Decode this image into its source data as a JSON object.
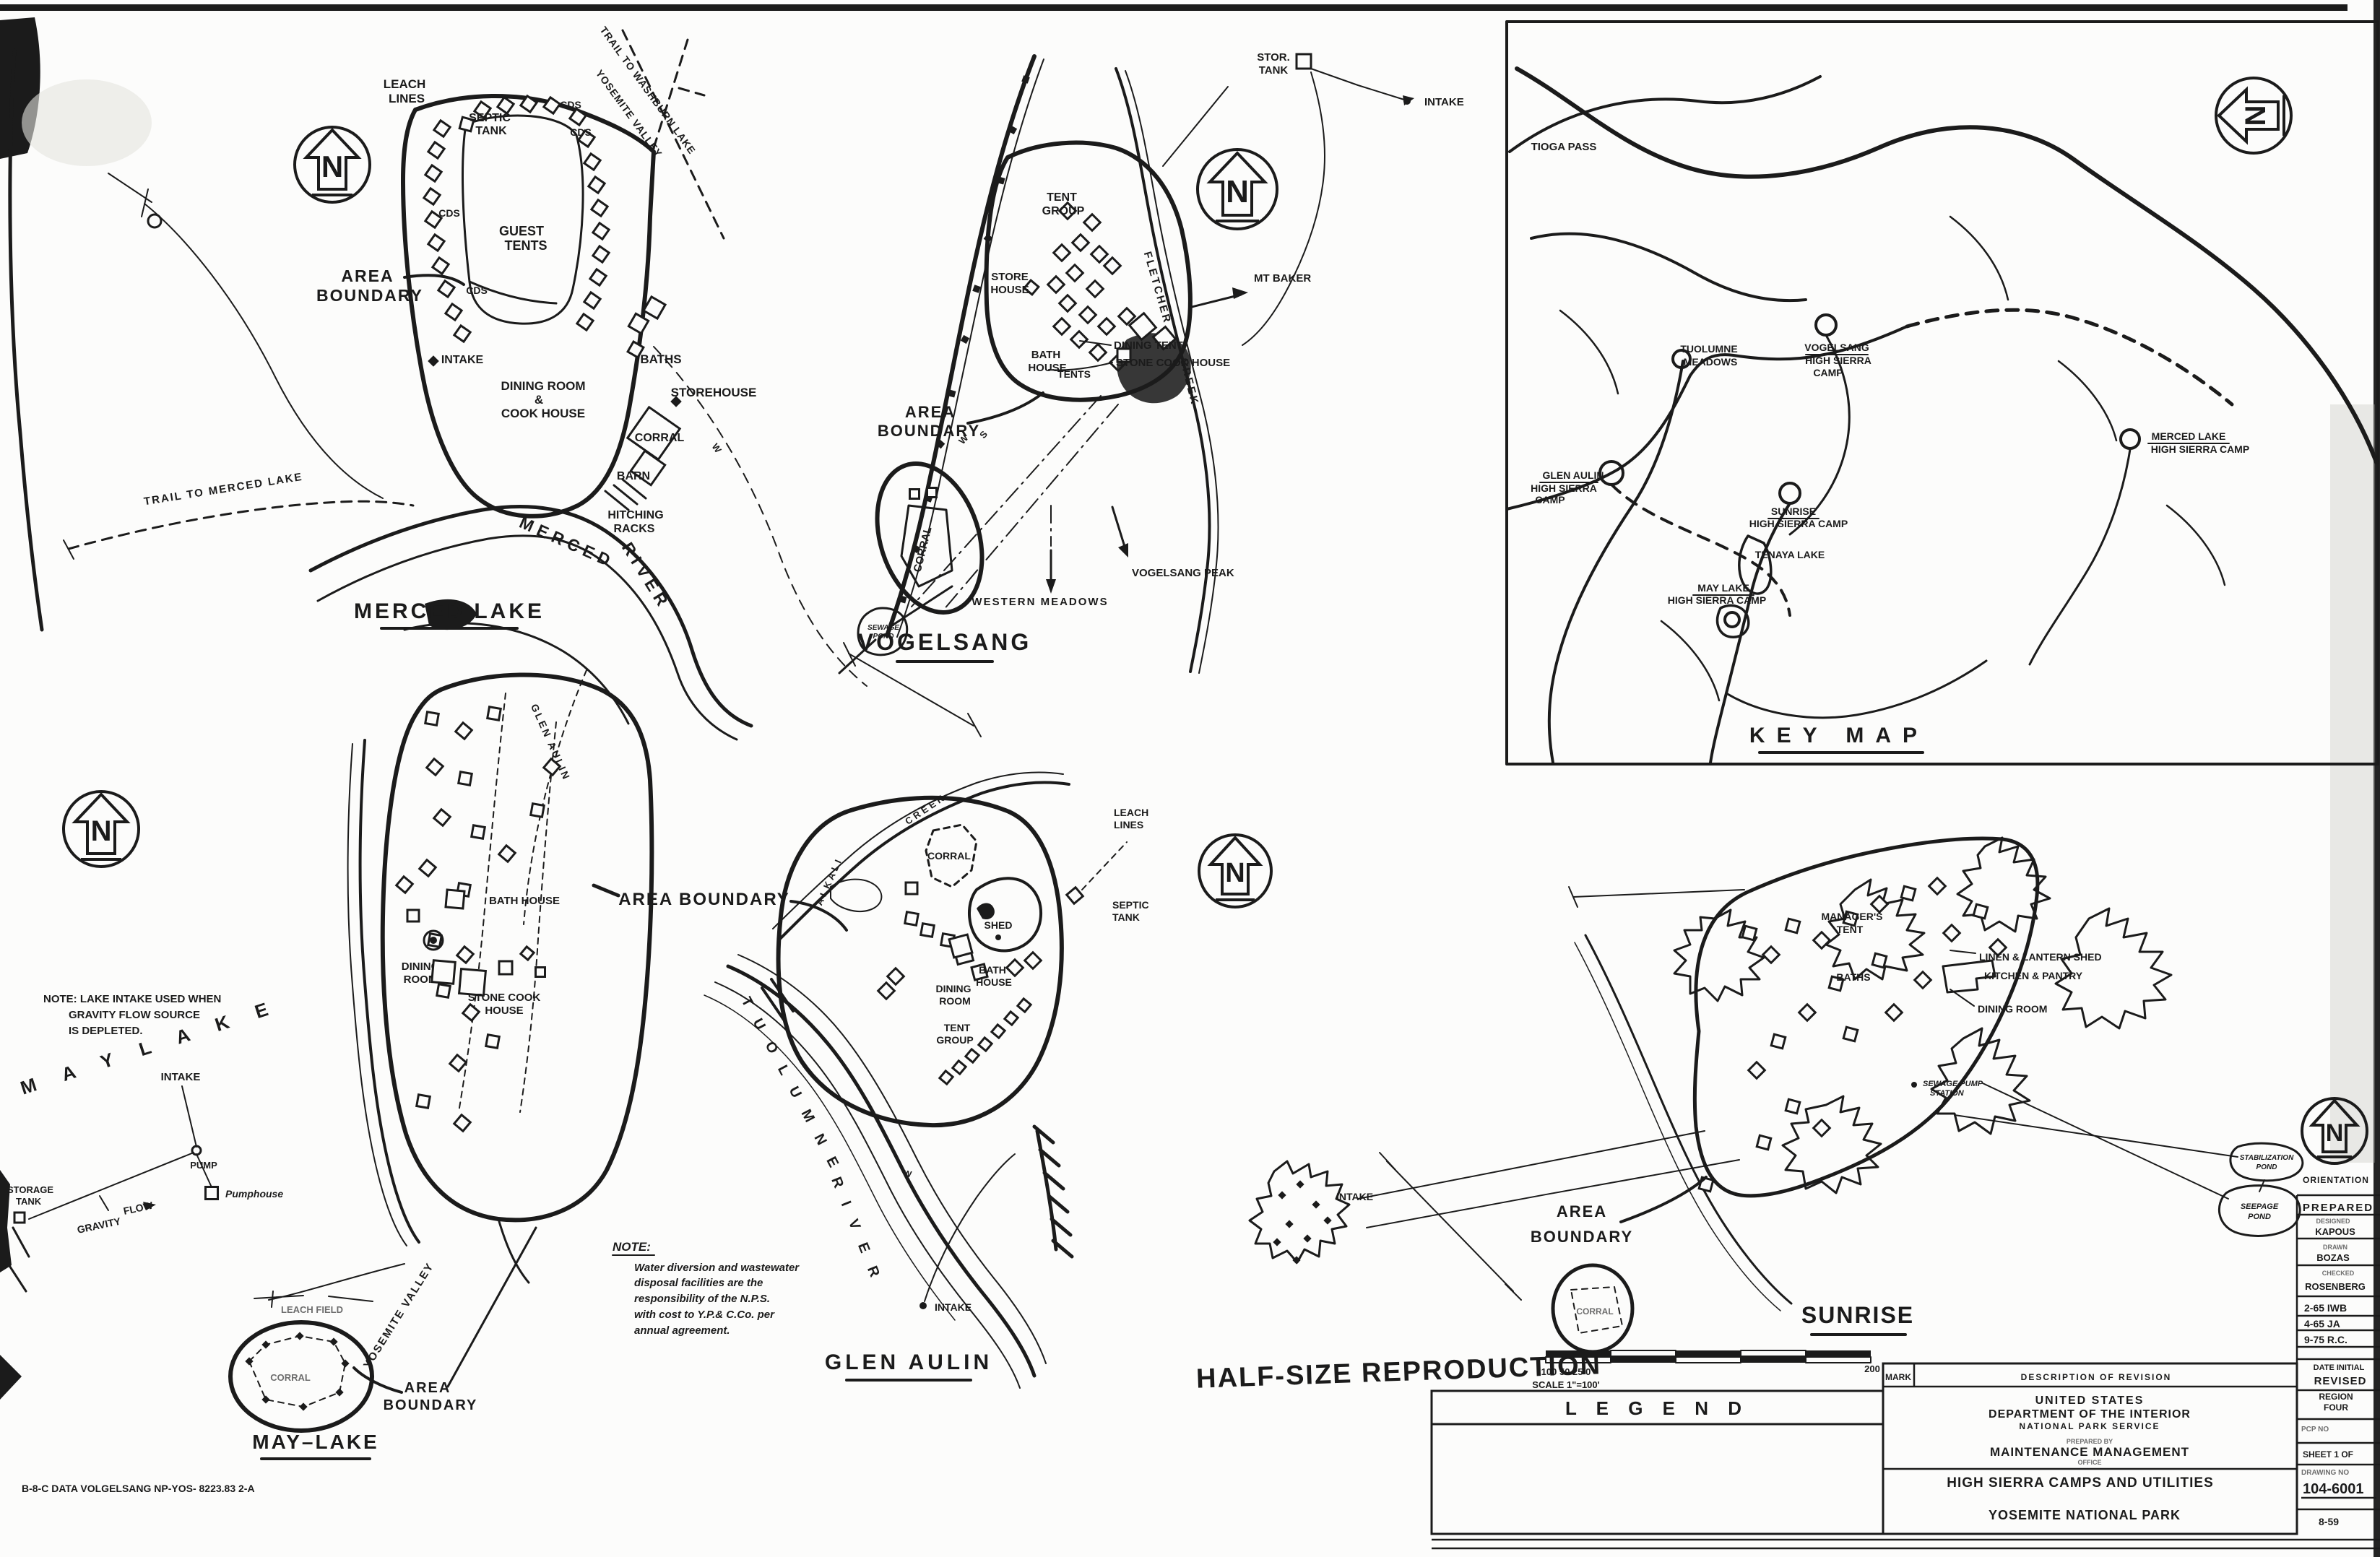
{
  "common": {
    "north": "N",
    "w": "W",
    "s": "S"
  },
  "merced": {
    "title": "MERCED LAKE",
    "leach": [
      "LEACH",
      "LINES"
    ],
    "septic": [
      "SEPTIC",
      "TANK"
    ],
    "guest": [
      "GUEST",
      "TENTS"
    ],
    "area": [
      "AREA",
      "BOUNDARY"
    ],
    "cds": "CDS",
    "intake": "INTAKE",
    "dining": [
      "DINING ROOM",
      "&",
      "COOK HOUSE"
    ],
    "baths": "BATHS",
    "storehouse": "STOREHOUSE",
    "corral": "CORRAL",
    "barn": "BARN",
    "hitching": [
      "HITCHING",
      "RACKS"
    ],
    "river": [
      "MERCED",
      "RIVER"
    ],
    "trail_merced": "TRAIL TO MERCED LAKE",
    "trail_washburn": "TRAIL TO WASHBURN LAKE",
    "trail_yosemite": "YOSEMITE VALLEY"
  },
  "vogelsang": {
    "title": "VOGELSANG",
    "stor_tank": [
      "STOR.",
      "TANK"
    ],
    "intake": "INTAKE",
    "tent_group": [
      "TENT",
      "GROUP"
    ],
    "store_house": [
      "STORE",
      "HOUSE"
    ],
    "bath_house": [
      "BATH",
      "HOUSE"
    ],
    "fletcher": [
      "FLETCHER",
      "CREEK"
    ],
    "dining_tent": "DINING TENT",
    "stone_cook": "STONE COOK HOUSE",
    "tents": "TENTS",
    "mt_baker": "MT BAKER",
    "area": [
      "AREA",
      "BOUNDARY"
    ],
    "corral": "CORRAL",
    "pond": [
      "SEWAGE",
      "POND"
    ],
    "western_meadows": "WESTERN MEADOWS",
    "vogelsang_peak": "VOGELSANG PEAK"
  },
  "keymap": {
    "title": "KEY MAP",
    "tioga": "TIOGA PASS",
    "tuolumne": [
      "TUOLUMNE",
      "MEADOWS"
    ],
    "vogelsang": [
      "VOGELSANG",
      "HIGH SIERRA",
      "CAMP"
    ],
    "merced": [
      "MERCED LAKE",
      "HIGH SIERRA CAMP"
    ],
    "glen_aulin": [
      "GLEN AULIN",
      "HIGH SIERRA",
      "CAMP"
    ],
    "sunrise": [
      "SUNRISE",
      "HIGH SIERRA CAMP"
    ],
    "tenaya": "TENAYA LAKE",
    "may_lake": [
      "MAY LAKE",
      "HIGH SIERRA CAMP"
    ]
  },
  "maylake": {
    "title": "MAY–LAKE",
    "note": [
      "NOTE: LAKE INTAKE USED WHEN",
      "GRAVITY FLOW SOURCE",
      "IS DEPLETED."
    ],
    "lake_name": "M A Y    L A K E",
    "glen_aulin_trail": "GLEN AULIN",
    "bath_house": "BATH HOUSE",
    "area_shared": "AREA BOUNDARY",
    "dining": [
      "DINING",
      "ROOM"
    ],
    "stone_cook": [
      "STONE COOK",
      "HOUSE"
    ],
    "intake": "INTAKE",
    "pump": "PUMP",
    "pumphouse": "Pumphouse",
    "storage": [
      "STORAGE",
      "TANK"
    ],
    "gravity": [
      "GRAVITY",
      "FLOW"
    ],
    "leach_field": "LEACH FIELD",
    "corral": "CORRAL",
    "area": [
      "AREA",
      "BOUNDARY"
    ],
    "yosemite_valley": "YOSEMITE VALLEY",
    "ref": "B-8-C DATA   VOLGELSANG   NP-YOS- 8223.83 2-A"
  },
  "glenaulin": {
    "title": "GLEN AULIN",
    "leach": [
      "LEACH",
      "LINES"
    ],
    "septic": [
      "SEPTIC",
      "TANK"
    ],
    "corral": "CORRAL",
    "shed": "SHED",
    "bath": [
      "BATH",
      "HOUSE"
    ],
    "dining": [
      "DINING",
      "ROOM"
    ],
    "tent_group": [
      "TENT",
      "GROUP"
    ],
    "alkali": "ALKALI",
    "creek": "CREEK",
    "tuolumne": "T U O L U M N E",
    "river": "R I V E R",
    "intake": "INTAKE",
    "note_head": "NOTE:",
    "note": [
      "Water diversion and wastewater",
      "disposal facilities are the",
      "responsibility of the N.P.S.",
      "with cost to Y.P.& C.Co. per",
      "annual agreement."
    ]
  },
  "sunrise": {
    "title": "SUNRISE",
    "managers": [
      "MANAGER'S",
      "TENT"
    ],
    "baths": "BATHS",
    "linen": "LINEN & LANTERN SHED",
    "kitchen": "KITCHEN & PANTRY",
    "dining": "DINING ROOM",
    "sewage_pump": [
      "SEWAGE PUMP",
      "STATION"
    ],
    "intake": "INTAKE",
    "area": [
      "AREA",
      "BOUNDARY"
    ],
    "corral": "CORRAL",
    "stab_pond": [
      "STABILIZATION",
      "POND"
    ],
    "seepage_pond": [
      "SEEPAGE",
      "POND"
    ],
    "orientation": "ORIENTATION"
  },
  "footer": {
    "half_size": "HALF-SIZE REPRODUCTION",
    "scale_left": "100   50  25  0",
    "scale_right": "200",
    "scale_label": "SCALE  1\"=100'",
    "legend": "L   E   G   E   N   D"
  },
  "titleblock": {
    "mark": "MARK",
    "desc": "DESCRIPTION  OF  REVISION",
    "us": "UNITED STATES",
    "dept": "DEPARTMENT OF THE INTERIOR",
    "nps": "NATIONAL PARK SERVICE",
    "prepared_by": "PREPARED BY",
    "maint": "MAINTENANCE   MANAGEMENT",
    "office": "OFFICE",
    "sheet_title": "HIGH SIERRA CAMPS AND UTILITIES",
    "park": "YOSEMITE NATIONAL PARK"
  },
  "sidebar": {
    "prepared": "PREPARED",
    "designed": "DESIGNED",
    "designed_by": "KAPOUS",
    "drawn": "DRAWN",
    "drawn_by": "BOZAS",
    "checked": "CHECKED",
    "checked_by": "ROSENBERG",
    "rev1": "2-65   IWB",
    "rev2": "4-65   JA",
    "rev3": "9-75   R.C.",
    "date_initial": "DATE  INITIAL",
    "revised": "REVISED",
    "region": [
      "REGION",
      "FOUR"
    ],
    "pcp": "PCP NO",
    "sheet": "SHEET 1 OF",
    "drawing_no": "DRAWING NO",
    "number": "104-6001",
    "date": "8-59"
  }
}
